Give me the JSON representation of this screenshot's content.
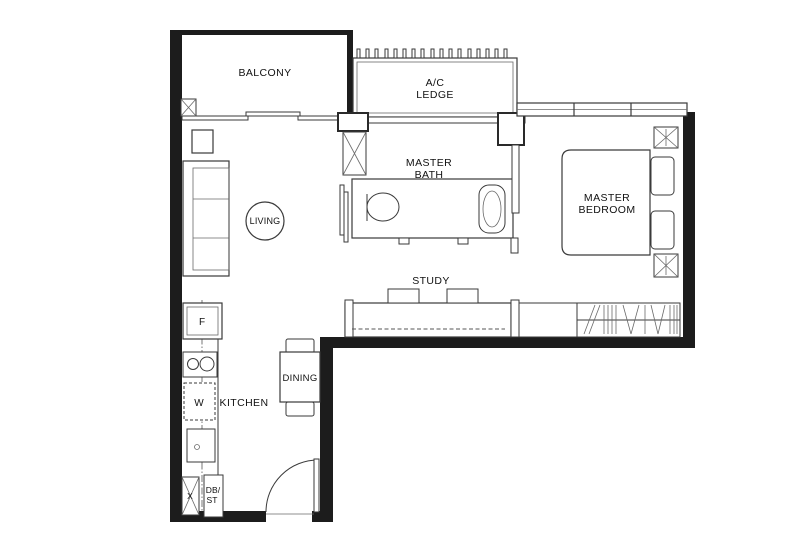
{
  "colors": {
    "wall": "#1c1c1c",
    "line": "#3a3a3a",
    "text": "#111111",
    "background": "#ffffff"
  },
  "rooms": {
    "balcony": {
      "label": "BALCONY"
    },
    "ac_ledge": {
      "line1": "A/C",
      "line2": "LEDGE"
    },
    "master_bath": {
      "line1": "MASTER",
      "line2": "BATH"
    },
    "master_bedroom": {
      "line1": "MASTER",
      "line2": "BEDROOM"
    },
    "living": {
      "label": "LIVING"
    },
    "study": {
      "label": "STUDY"
    },
    "dining": {
      "label": "DINING"
    },
    "kitchen": {
      "label": "KITCHEN"
    }
  },
  "fixtures": {
    "fridge": {
      "label": "F"
    },
    "washer": {
      "label": "W"
    },
    "store": {
      "label": "X"
    },
    "db_st": {
      "line1": "DB/",
      "line2": "ST"
    }
  }
}
